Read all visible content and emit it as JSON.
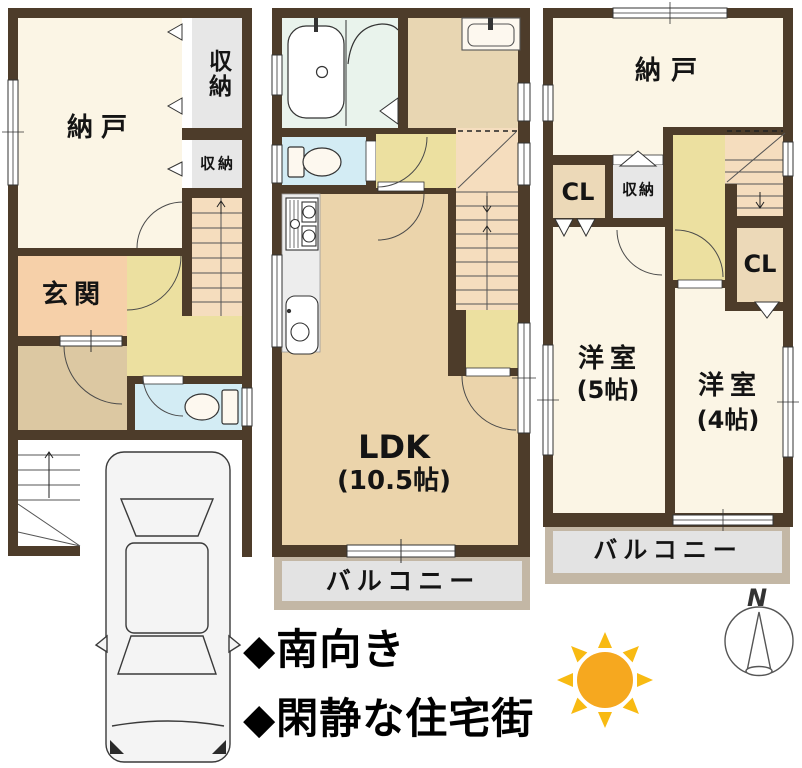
{
  "colors": {
    "wall": "#4d3c2a",
    "room_cream": "#fbf5e5",
    "room_tan": "#ebd4ab",
    "hall_yellow": "#ece0a0",
    "stairs_orange": "#f5ddbe",
    "genkan_salmon": "#f6d0a9",
    "toilet_blue": "#d3ecf4",
    "bath_mint": "#e9f3ec",
    "closet_gray": "#e7e7e7",
    "balcony_frame": "#c3b7a5",
    "balcony_inner": "#e3e3e3",
    "sun_core": "#f6a81f",
    "sun_rays": "#f8ba12"
  },
  "floor1": {
    "nando_label": "納戸",
    "closet_top_label": "収納",
    "closet_small_label": "収納",
    "genkan_label": "玄関"
  },
  "floor2": {
    "ldk_label": "LDK",
    "ldk_size_label": "(10.5帖)",
    "balcony_label": "バルコニー"
  },
  "floor3": {
    "nando_label": "納戸",
    "cl_left_label": "CL",
    "closet_label": "収納",
    "cl_right_label": "CL",
    "room5_label": "洋室",
    "room5_size_label": "(5帖)",
    "room4_label": "洋室",
    "room4_size_label": "(4帖)",
    "balcony_label": "バルコニー"
  },
  "annotations": {
    "line1": "◆南向き",
    "line2": "◆閑静な住宅街"
  },
  "compass": {
    "north_label": "N"
  },
  "icons": {
    "sun": "sun-icon",
    "compass": "compass-icon",
    "car": "car-top-view-icon",
    "bathtub": "bathtub-icon",
    "toilet": "toilet-icon",
    "stove": "stove-icon",
    "kitchen_sink": "kitchen-sink-icon",
    "washbasin": "washbasin-icon"
  }
}
